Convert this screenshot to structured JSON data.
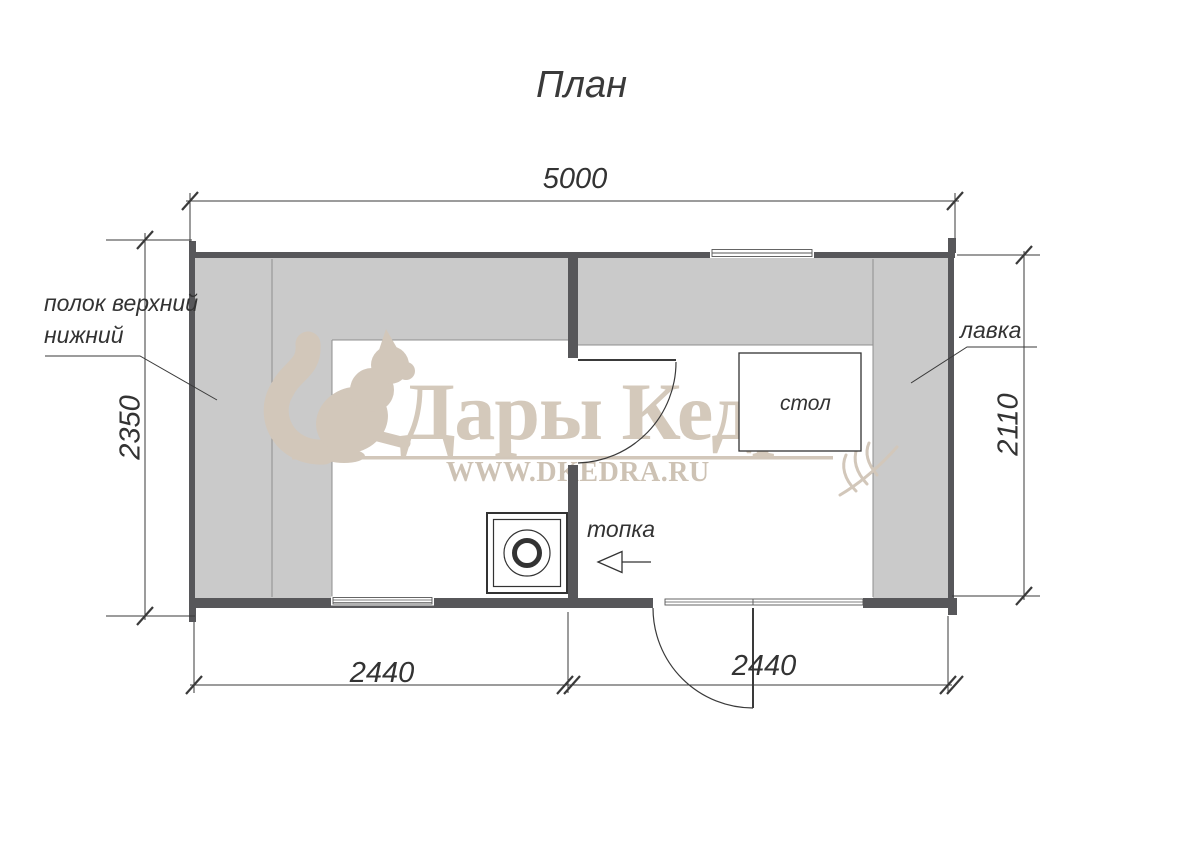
{
  "title": "План",
  "watermark": {
    "brand": "Дары Кедра",
    "url": "WWW.DKEDRA.RU",
    "logo_icon": "squirrel",
    "color": "#d2c7ba"
  },
  "dimensions": {
    "overall_width": "5000",
    "left_height": "2350",
    "right_height": "2110",
    "bottom_left_width": "2440",
    "bottom_right_width": "2440"
  },
  "labels": {
    "shelf_line1": "полок верхний",
    "shelf_line2": "нижний",
    "bench": "лавка",
    "table": "стол",
    "firebox": "топка"
  },
  "colors": {
    "wall": "#57575a",
    "shelf_fill": "#cacaca",
    "shelf_edge": "#8f8f8f",
    "line": "#3a3a3a",
    "watermark": "#d2c7ba"
  }
}
